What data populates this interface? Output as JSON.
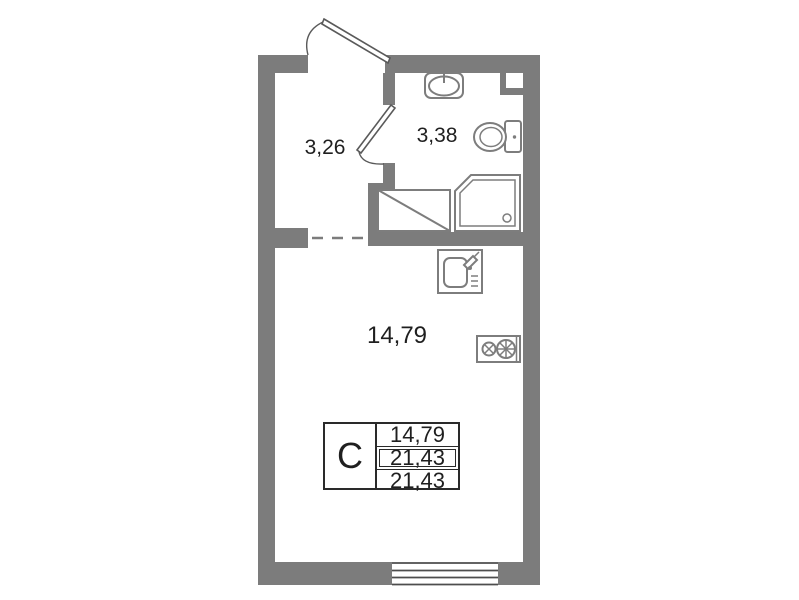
{
  "rooms": {
    "hallway": {
      "area": "3,26"
    },
    "bathroom": {
      "area": "3,38"
    },
    "living": {
      "area": "14,79"
    }
  },
  "legend": {
    "unit_type": "С",
    "values": [
      "14,79",
      "21,43",
      "21,43"
    ]
  },
  "fixtures": [
    "entrance-door",
    "bathroom-door",
    "washbasin",
    "toilet",
    "shower",
    "washing-machine",
    "kitchen-sink",
    "stove",
    "window",
    "vent-shaft"
  ],
  "colors": {
    "wall": "#7c7c7c",
    "fixture": "#7d7d7d",
    "outline": "#5a5a5a",
    "text": "#1f1f1f"
  }
}
